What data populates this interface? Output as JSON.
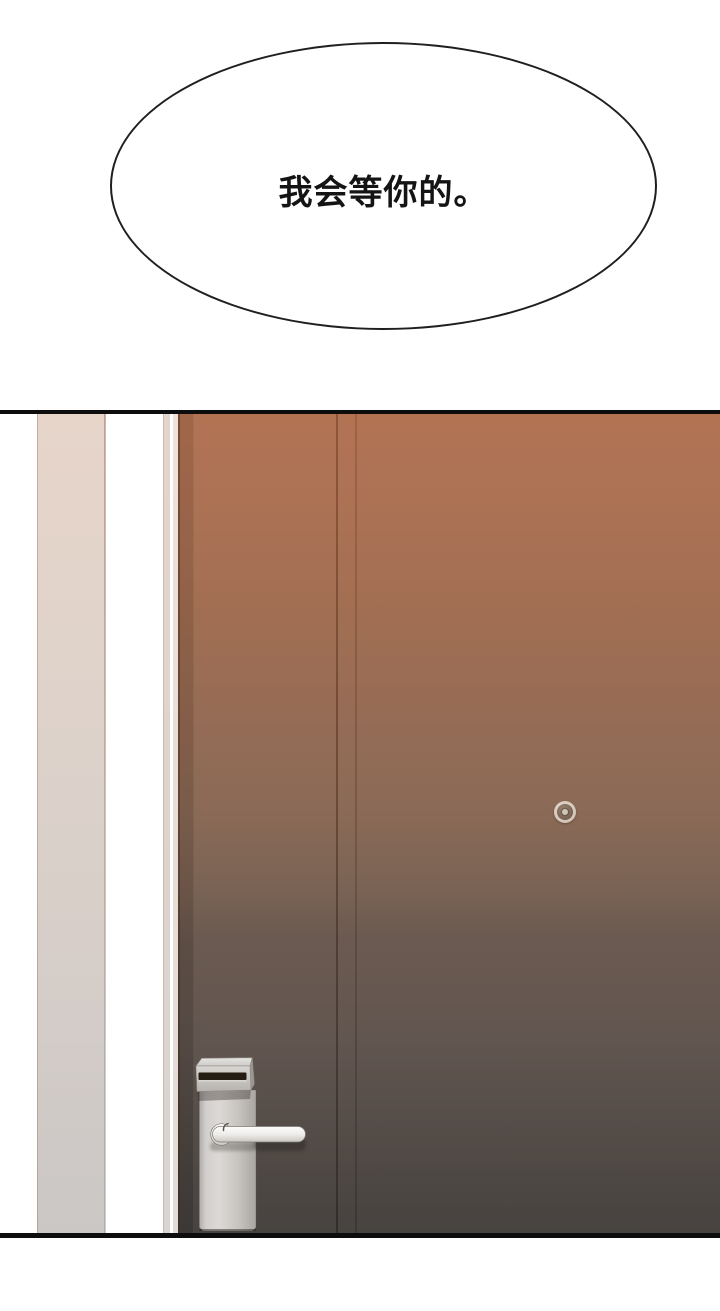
{
  "speech_bubble": {
    "text": "我会等你的。"
  },
  "colors": {
    "bubble_stroke": "#1f1f1f",
    "bubble_text": "#141414",
    "panel_border": "#0d0d0d",
    "door_top": "#b27353",
    "door_mid": "#8a6a57",
    "door_bottom": "#474340",
    "wall_top": "#e7d5ca",
    "wall_bottom": "#cac7c5",
    "card_slot": "#251d14",
    "handle_metal": "#fbfbfa",
    "plate_metal": "#d9d6d3"
  }
}
